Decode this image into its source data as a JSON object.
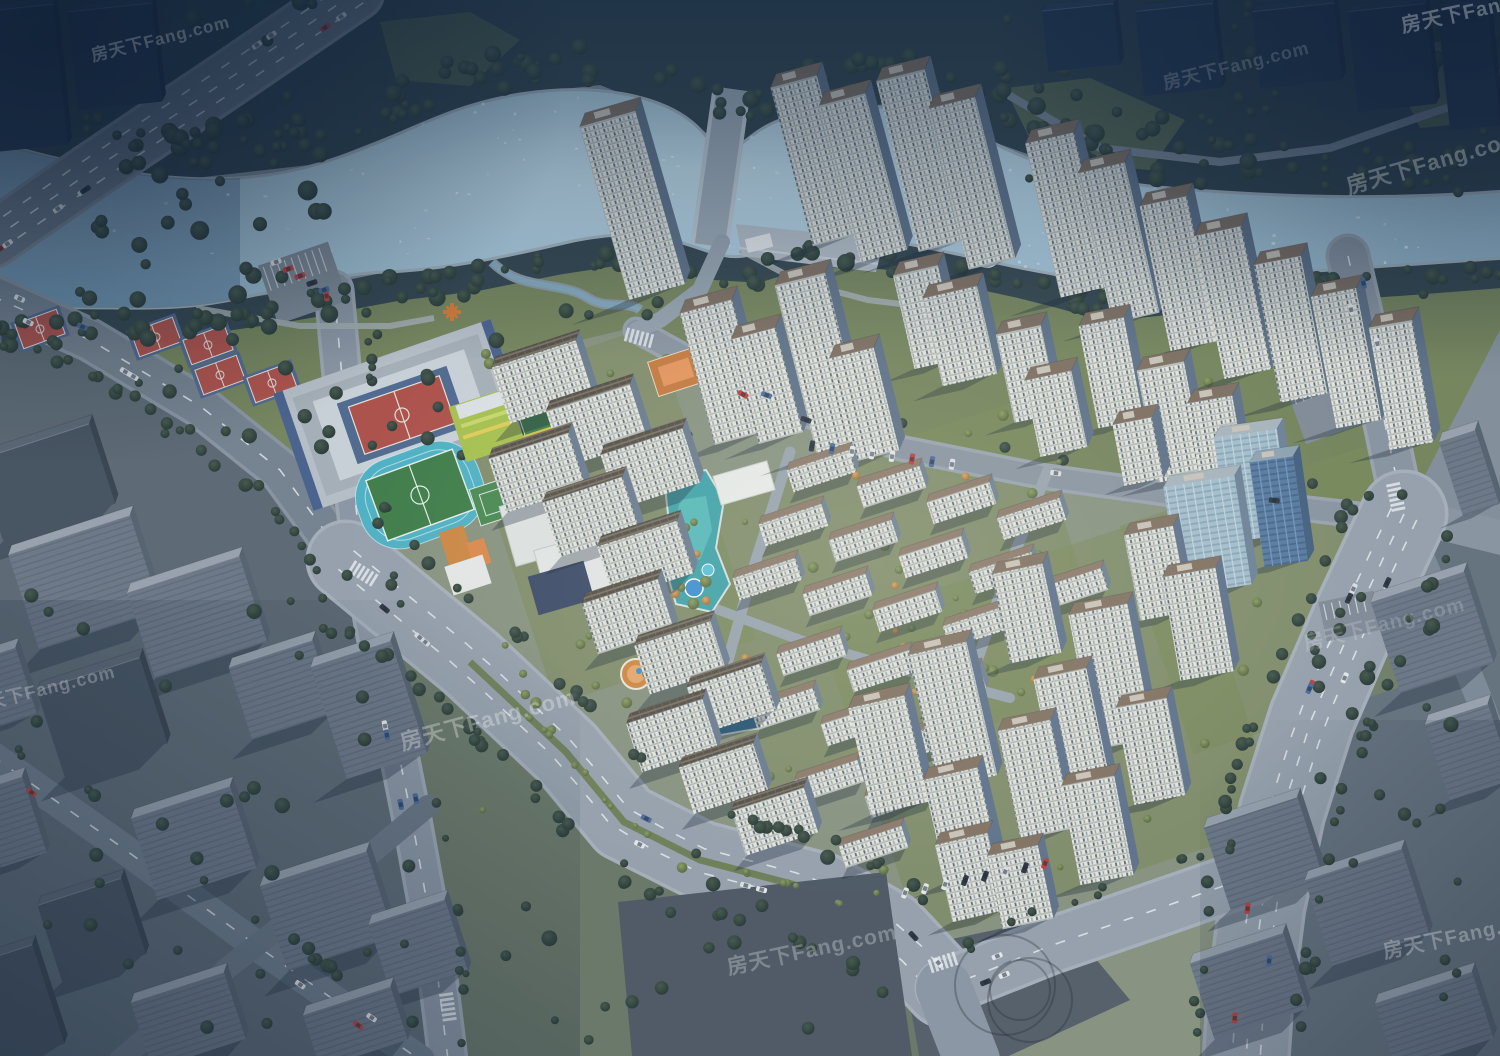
{
  "meta": {
    "type": "architectural-aerial-render",
    "description": "Bird's-eye rendering of a large riverside residential development with lakeside park, school campus, sports courts, high-rise towers and surrounding city blocks"
  },
  "watermark": {
    "text": "房天下Fang.com",
    "brand": "Fang.com",
    "count": 9
  },
  "palette": {
    "water": "#9fc2d6",
    "forest": "#2e4048",
    "park": "#76855a",
    "road": "#98a2ac",
    "facade": "#e9e7dd",
    "facade_shade": "#7c8c9e",
    "roof": "#7e6e5f",
    "court_red": "#b05048",
    "court_blue": "#51698e",
    "track_cyan": "#4fb3c4",
    "pitch_green": "#3f7d46",
    "school_lime": "#a9c24c",
    "accent_orange": "#d08840",
    "pool_teal": "#3fa3a8",
    "blossom": "#e8a2ba"
  },
  "scene": {
    "features": [
      "winding river",
      "riverside forest belt",
      "lakeside park",
      "basketball courts",
      "terraced plaza",
      "school running track and football pitch",
      "kindergarten",
      "high-rise residential towers",
      "mid-rise apartment slabs",
      "low-rise rows",
      "courtyard swimming pools",
      "tree-lined boulevards",
      "surrounding grey city blocks"
    ]
  }
}
